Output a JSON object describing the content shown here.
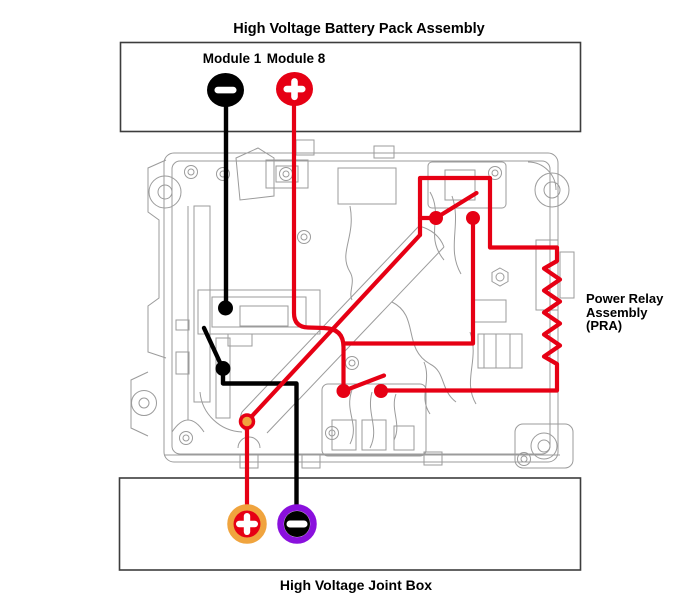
{
  "battery_pack": {
    "title": "High Voltage Battery Pack Assembly",
    "module1_label": "Module 1",
    "module8_label": "Module 8"
  },
  "pra": {
    "line1": "Power Relay",
    "line2": "Assembly",
    "line3": "(PRA)"
  },
  "joint_box": {
    "title": "High Voltage Joint Box"
  },
  "terminals": {
    "module1_polarity": "minus",
    "module8_polarity": "plus",
    "joint_positive_polarity": "plus",
    "joint_negative_polarity": "minus"
  },
  "colors": {
    "positive_red": "#e60014",
    "negative_black": "#000000",
    "joint_positive_ring_orange": "#f0a43e",
    "joint_negative_ring_purple": "#8a10dd",
    "junction_dot_orange": "#f0a43e",
    "drawing_gray": "#9b9b9b",
    "box_border": "#3d3d3d"
  }
}
